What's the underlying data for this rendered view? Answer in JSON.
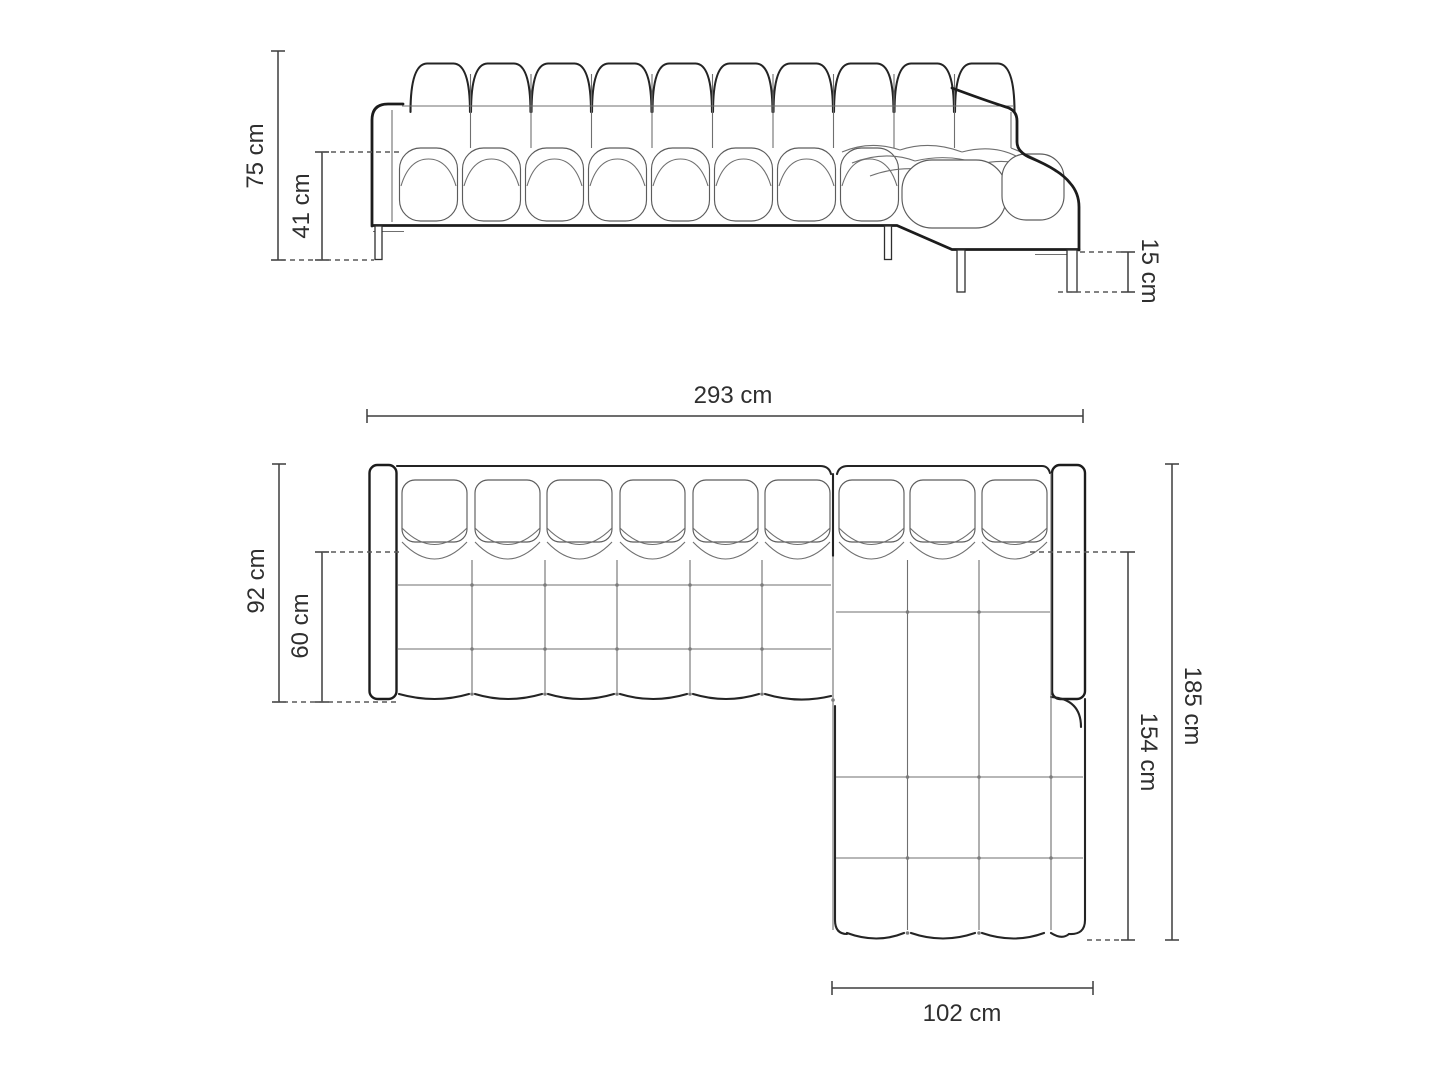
{
  "diagram": {
    "subject": "corner-sofa-with-chaise-dimension-drawing",
    "unit": "cm",
    "views": {
      "front": "front elevation",
      "plan": "top plan"
    }
  },
  "dimensions": {
    "front": {
      "total_height": "75 cm",
      "seat_height": "41 cm",
      "leg_height": "15 cm"
    },
    "plan": {
      "total_width": "293 cm",
      "sofa_depth": "92 cm",
      "seat_depth": "60 cm",
      "total_depth": "185 cm",
      "chaise_length": "154 cm",
      "chaise_width": "102 cm"
    }
  }
}
